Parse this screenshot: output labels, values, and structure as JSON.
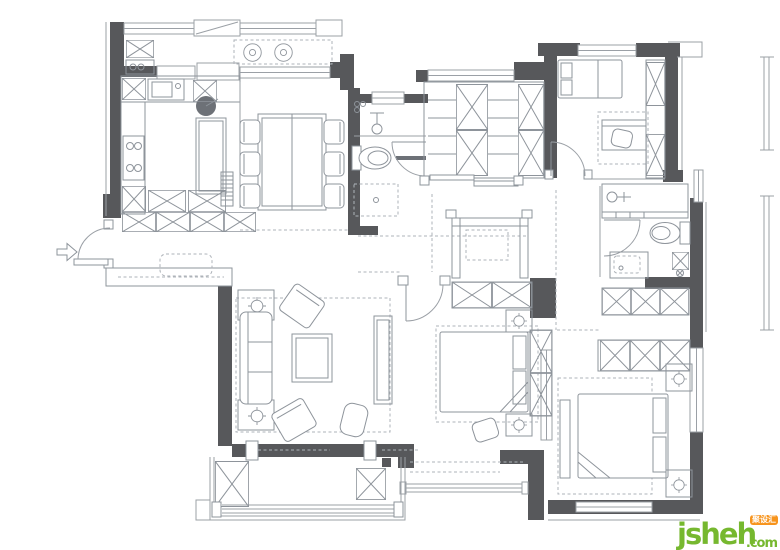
{
  "watermark": {
    "brand": "jsheh",
    "tld": ".com",
    "badge": "聚设汇"
  },
  "colors": {
    "background": "#FFFFFF",
    "wall": "#57585B",
    "line": "#9BA0A6",
    "furniture": "#8E949B",
    "dashed": "#AEB3B9",
    "watermark_green": "#76B82F",
    "watermark_orange": "#F7941D"
  },
  "drawing": {
    "type": "apartment-floor-plan",
    "entrance_marker": "arrow-pointing-right",
    "rooms": [
      "entry",
      "kitchen",
      "dining-room",
      "living-room",
      "laundry-balcony",
      "guest-bathroom",
      "walk-in-closet",
      "study-bedroom",
      "ensuite-bathroom",
      "middle-bedroom",
      "master-bedroom",
      "south-balcony",
      "hallway"
    ]
  }
}
